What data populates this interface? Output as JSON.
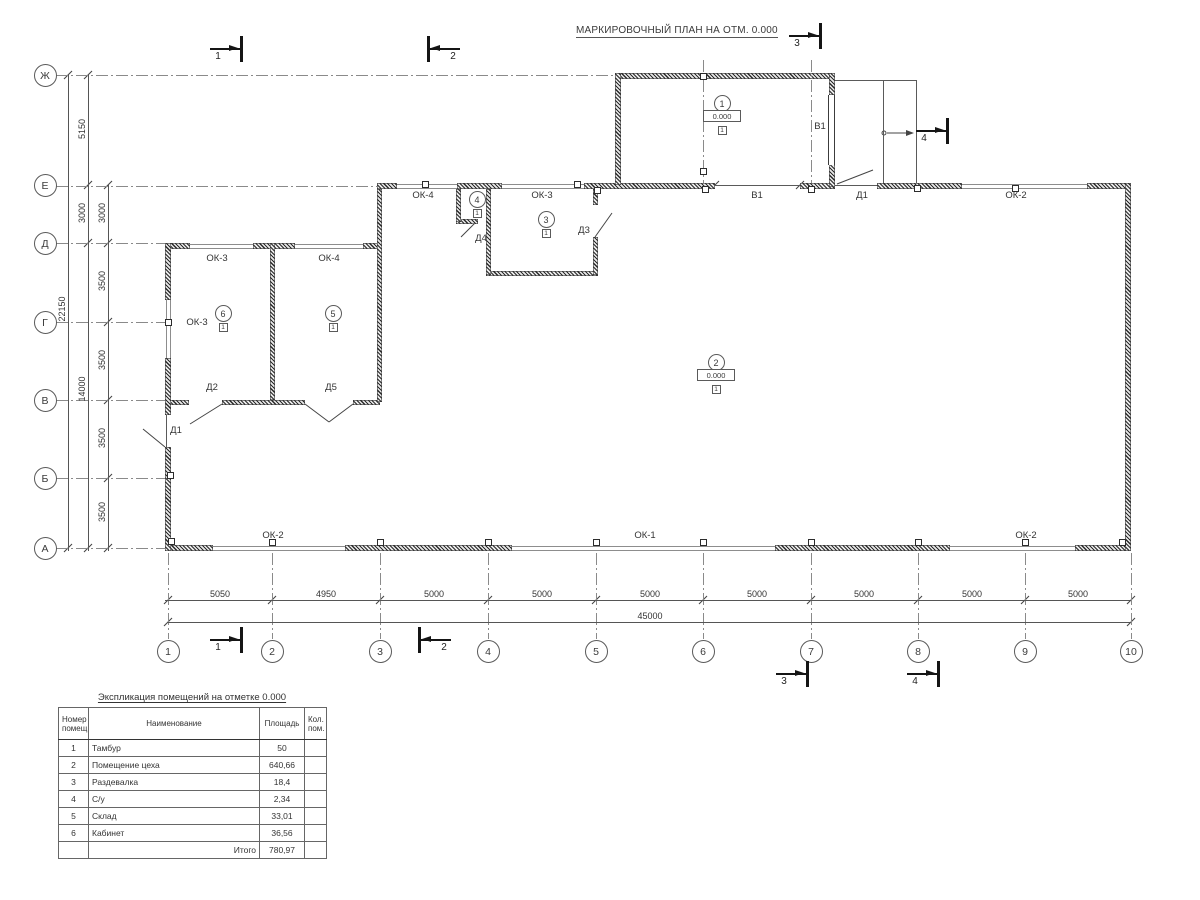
{
  "drawing_title": "МАРКИРОВОЧНЫЙ ПЛАН НА ОТМ. 0.000",
  "axis_rows": [
    {
      "label": "Ж",
      "y": 75
    },
    {
      "label": "Е",
      "y": 185
    },
    {
      "label": "Д",
      "y": 243
    },
    {
      "label": "Г",
      "y": 322
    },
    {
      "label": "В",
      "y": 400
    },
    {
      "label": "Б",
      "y": 478
    },
    {
      "label": "А",
      "y": 548
    }
  ],
  "axis_cols": [
    {
      "label": "1",
      "x": 168
    },
    {
      "label": "2",
      "x": 272
    },
    {
      "label": "3",
      "x": 380
    },
    {
      "label": "4",
      "x": 488
    },
    {
      "label": "5",
      "x": 596
    },
    {
      "label": "6",
      "x": 703
    },
    {
      "label": "7",
      "x": 811
    },
    {
      "label": "8",
      "x": 918
    },
    {
      "label": "9",
      "x": 1025
    },
    {
      "label": "10",
      "x": 1131
    }
  ],
  "dim_left": [
    {
      "text": "22150",
      "x": 62,
      "y": 310
    },
    {
      "text": "5150",
      "x": 82,
      "y": 130
    },
    {
      "text": "3000",
      "x": 82,
      "y": 214
    },
    {
      "text": "14000",
      "x": 82,
      "y": 390
    },
    {
      "text": "3000",
      "x": 102,
      "y": 214
    },
    {
      "text": "3500",
      "x": 102,
      "y": 282
    },
    {
      "text": "3500",
      "x": 102,
      "y": 361
    },
    {
      "text": "3500",
      "x": 102,
      "y": 439
    },
    {
      "text": "3500",
      "x": 102,
      "y": 513
    }
  ],
  "dim_bottom": {
    "segments": [
      {
        "text": "5050",
        "x": 220
      },
      {
        "text": "4950",
        "x": 326
      },
      {
        "text": "5000",
        "x": 434
      },
      {
        "text": "5000",
        "x": 542
      },
      {
        "text": "5000",
        "x": 650
      },
      {
        "text": "5000",
        "x": 757
      },
      {
        "text": "5000",
        "x": 864
      },
      {
        "text": "5000",
        "x": 972
      },
      {
        "text": "5000",
        "x": 1078
      }
    ],
    "total": {
      "text": "45000",
      "x": 650,
      "y": 611
    }
  },
  "plan_labels": [
    {
      "text": "ОК-4",
      "x": 423,
      "y": 196
    },
    {
      "text": "ОК-3",
      "x": 542,
      "y": 196
    },
    {
      "text": "В1",
      "x": 757,
      "y": 196
    },
    {
      "text": "Д1",
      "x": 862,
      "y": 196
    },
    {
      "text": "ОК-2",
      "x": 1016,
      "y": 196
    },
    {
      "text": "В1",
      "x": 820,
      "y": 127
    },
    {
      "text": "Д3",
      "x": 584,
      "y": 231
    },
    {
      "text": "Д4",
      "x": 481,
      "y": 239
    },
    {
      "text": "ОК-3",
      "x": 217,
      "y": 259
    },
    {
      "text": "ОК-4",
      "x": 329,
      "y": 259
    },
    {
      "text": "ОК-3",
      "x": 197,
      "y": 323
    },
    {
      "text": "Д2",
      "x": 212,
      "y": 388
    },
    {
      "text": "Д5",
      "x": 331,
      "y": 388
    },
    {
      "text": "Д1",
      "x": 176,
      "y": 431
    },
    {
      "text": "ОК-2",
      "x": 273,
      "y": 536
    },
    {
      "text": "ОК-1",
      "x": 645,
      "y": 536
    },
    {
      "text": "ОК-2",
      "x": 1026,
      "y": 536
    }
  ],
  "rooms": [
    {
      "num": "1",
      "x": 722,
      "y": 103,
      "elevation": "0.000",
      "floor_type": "1"
    },
    {
      "num": "2",
      "x": 716,
      "y": 362,
      "elevation": "0.000",
      "floor_type": "1"
    },
    {
      "num": "3",
      "x": 546,
      "y": 219,
      "floor_type": "1"
    },
    {
      "num": "4",
      "x": 477,
      "y": 199,
      "floor_type": "1"
    },
    {
      "num": "5",
      "x": 333,
      "y": 313,
      "floor_type": "1"
    },
    {
      "num": "6",
      "x": 223,
      "y": 313,
      "floor_type": "1"
    }
  ],
  "sections": [
    {
      "num": "1",
      "bar": 240,
      "y": 49,
      "dir": "r"
    },
    {
      "num": "2",
      "bar": 427,
      "y": 49,
      "dir": "l"
    },
    {
      "num": "3",
      "bar": 819,
      "y": 36,
      "dir": "r"
    },
    {
      "num": "4",
      "bar": 946,
      "y": 131,
      "dir": "r"
    },
    {
      "num": "1",
      "bar": 240,
      "y": 640,
      "dir": "r"
    },
    {
      "num": "2",
      "bar": 418,
      "y": 640,
      "dir": "l"
    },
    {
      "num": "3",
      "bar": 806,
      "y": 674,
      "dir": "r"
    },
    {
      "num": "4",
      "bar": 937,
      "y": 674,
      "dir": "r"
    }
  ],
  "legend_table": {
    "title": "Экспликация помещений на отметке 0.000",
    "headers": [
      "Номер помещ.",
      "Наименование",
      "Площадь",
      "Кол. пом."
    ],
    "rows": [
      {
        "num": "1",
        "name": "Тамбур",
        "area": "50",
        "count": ""
      },
      {
        "num": "2",
        "name": "Помещение цеха",
        "area": "640,66",
        "count": ""
      },
      {
        "num": "3",
        "name": "Раздевалка",
        "area": "18,4",
        "count": ""
      },
      {
        "num": "4",
        "name": "С/у",
        "area": "2,34",
        "count": ""
      },
      {
        "num": "5",
        "name": "Склад",
        "area": "33,01",
        "count": ""
      },
      {
        "num": "6",
        "name": "Кабинет",
        "area": "36,56",
        "count": ""
      }
    ],
    "total_label": "Итого",
    "total_value": "780,97"
  }
}
